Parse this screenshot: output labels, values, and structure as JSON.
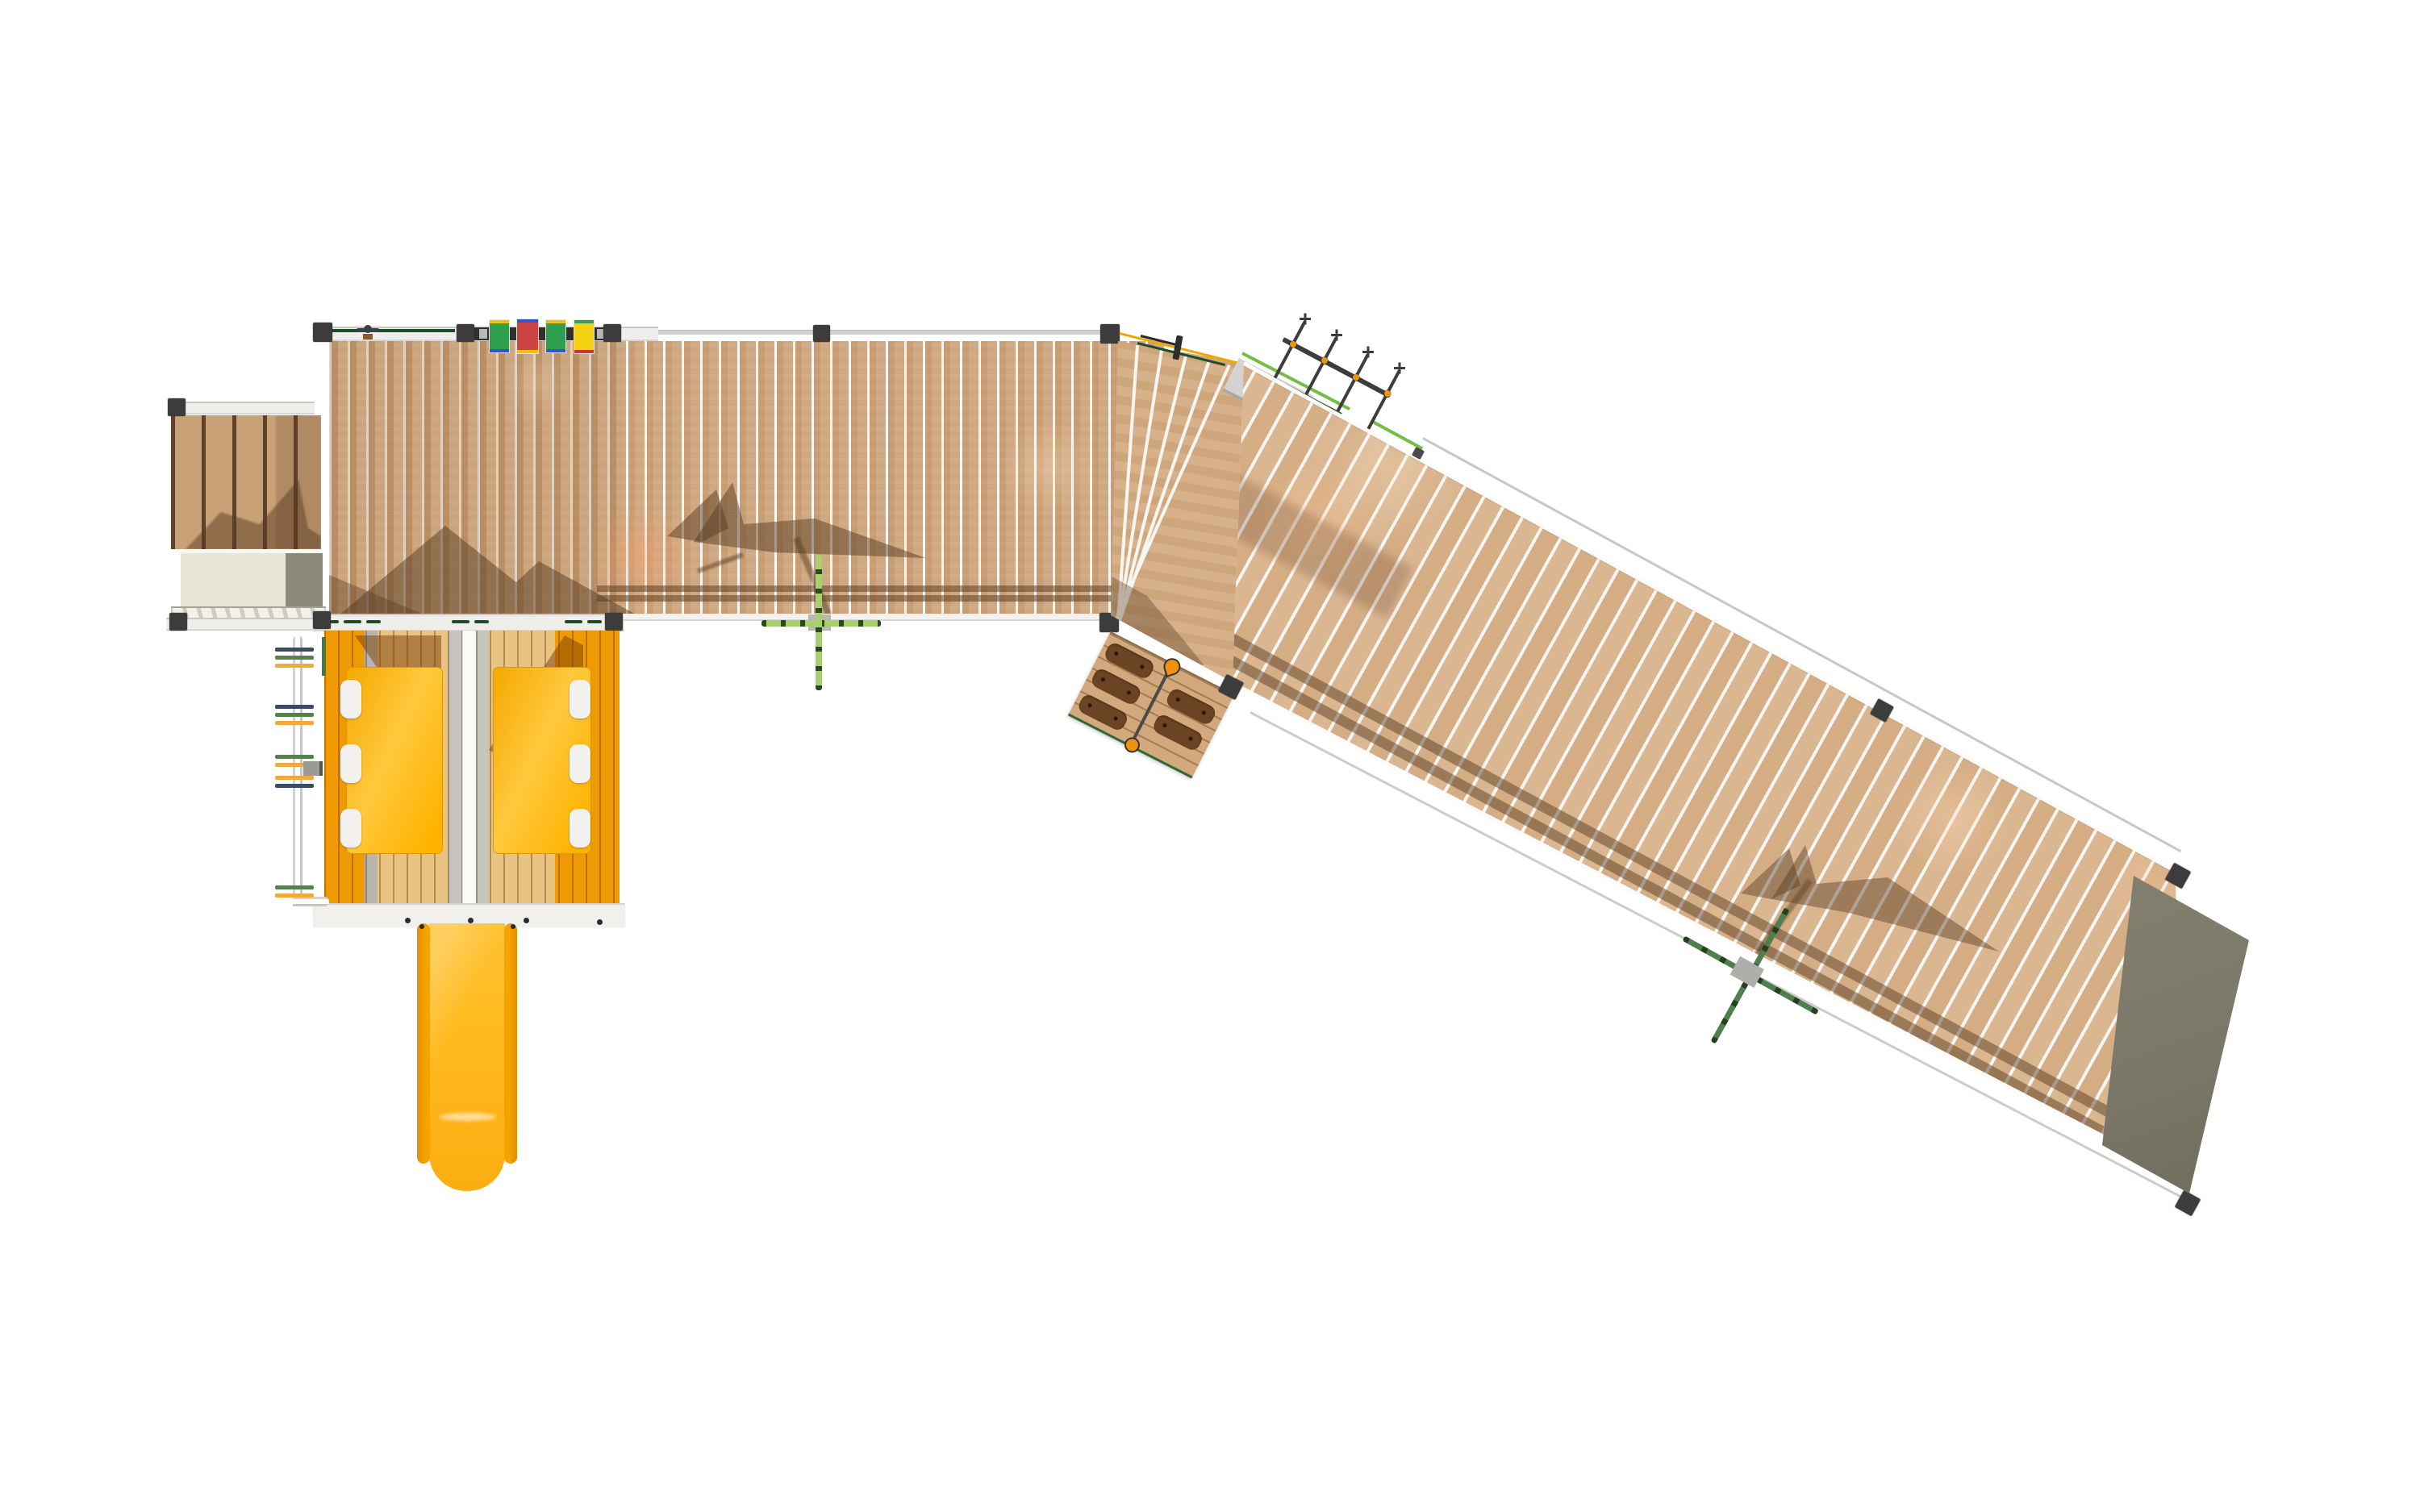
{
  "title": "Playground structure — top (plan) view render",
  "background": "#ffffff",
  "colors": {
    "wood": "#cfa77e",
    "wood-light": "#d8b28b",
    "wood-stairs": "#c9a176",
    "wood-fan": "#d5ad84",
    "gap": "#f8f6f2",
    "post": "#3c3c3c",
    "rail-white": "#efeeea",
    "rail-gray": "#c9c7c3",
    "booth-orange": "#ef9a05",
    "booth-tan": "#e8c382",
    "roof": "#ffb60a",
    "slide-rail": "#f5a300",
    "slide-bed": "#ffba1e",
    "p-green": "#2e9e4f",
    "p-red": "#cc4444",
    "p-yellow": "#f5d312",
    "a-blue": "#3355cc",
    "a-yellow": "#f2c200",
    "a-red": "#cc3333",
    "plant-light": "#a9cf70",
    "plant-dark": "#4e7f4e",
    "rope-yellow": "#f0a800",
    "rope-green": "#74bf43",
    "net": "#3d3d3d",
    "net-joint": "#f0930a",
    "slab": "#7b7869",
    "crate": "#e9e6d9",
    "crate-gray": "#8c897b",
    "handrail": "#1d4d28",
    "hold": "#6b4423",
    "wheel": "#33424d"
  },
  "components": {
    "stair_platform": "access stairs with five treads",
    "main_platform": "square play deck with activity panels",
    "bridge": "straight plank walkway",
    "fan_turn": "fanned plank turn section",
    "ramp": "long sloping plank walkway",
    "end_slab": "grey ground ramp pad",
    "booths": "two orange play booths with yellow roofs",
    "slide": "yellow straight slide",
    "climb_pole": "rung climbing pole",
    "climbing_wall": "inclined climbing wall with hand holds and rope",
    "net_climber": "rope net climber",
    "plants": "two sapling markers with cast tree shadows"
  },
  "play_panels": [
    {
      "color": "green",
      "top_accent": "yellow",
      "bottom_accent": "blue"
    },
    {
      "color": "red",
      "top_accent": "blue",
      "bottom_accent": "yellow"
    },
    {
      "color": "green",
      "top_accent": "yellow",
      "bottom_accent": "blue"
    },
    {
      "color": "yellow",
      "top_accent": "green",
      "bottom_accent": "red"
    }
  ],
  "counts": {
    "roof_tabs_per_booth": 3,
    "climb_wall_holds": 5,
    "net_rungs": 4,
    "stair_treads": 5
  }
}
